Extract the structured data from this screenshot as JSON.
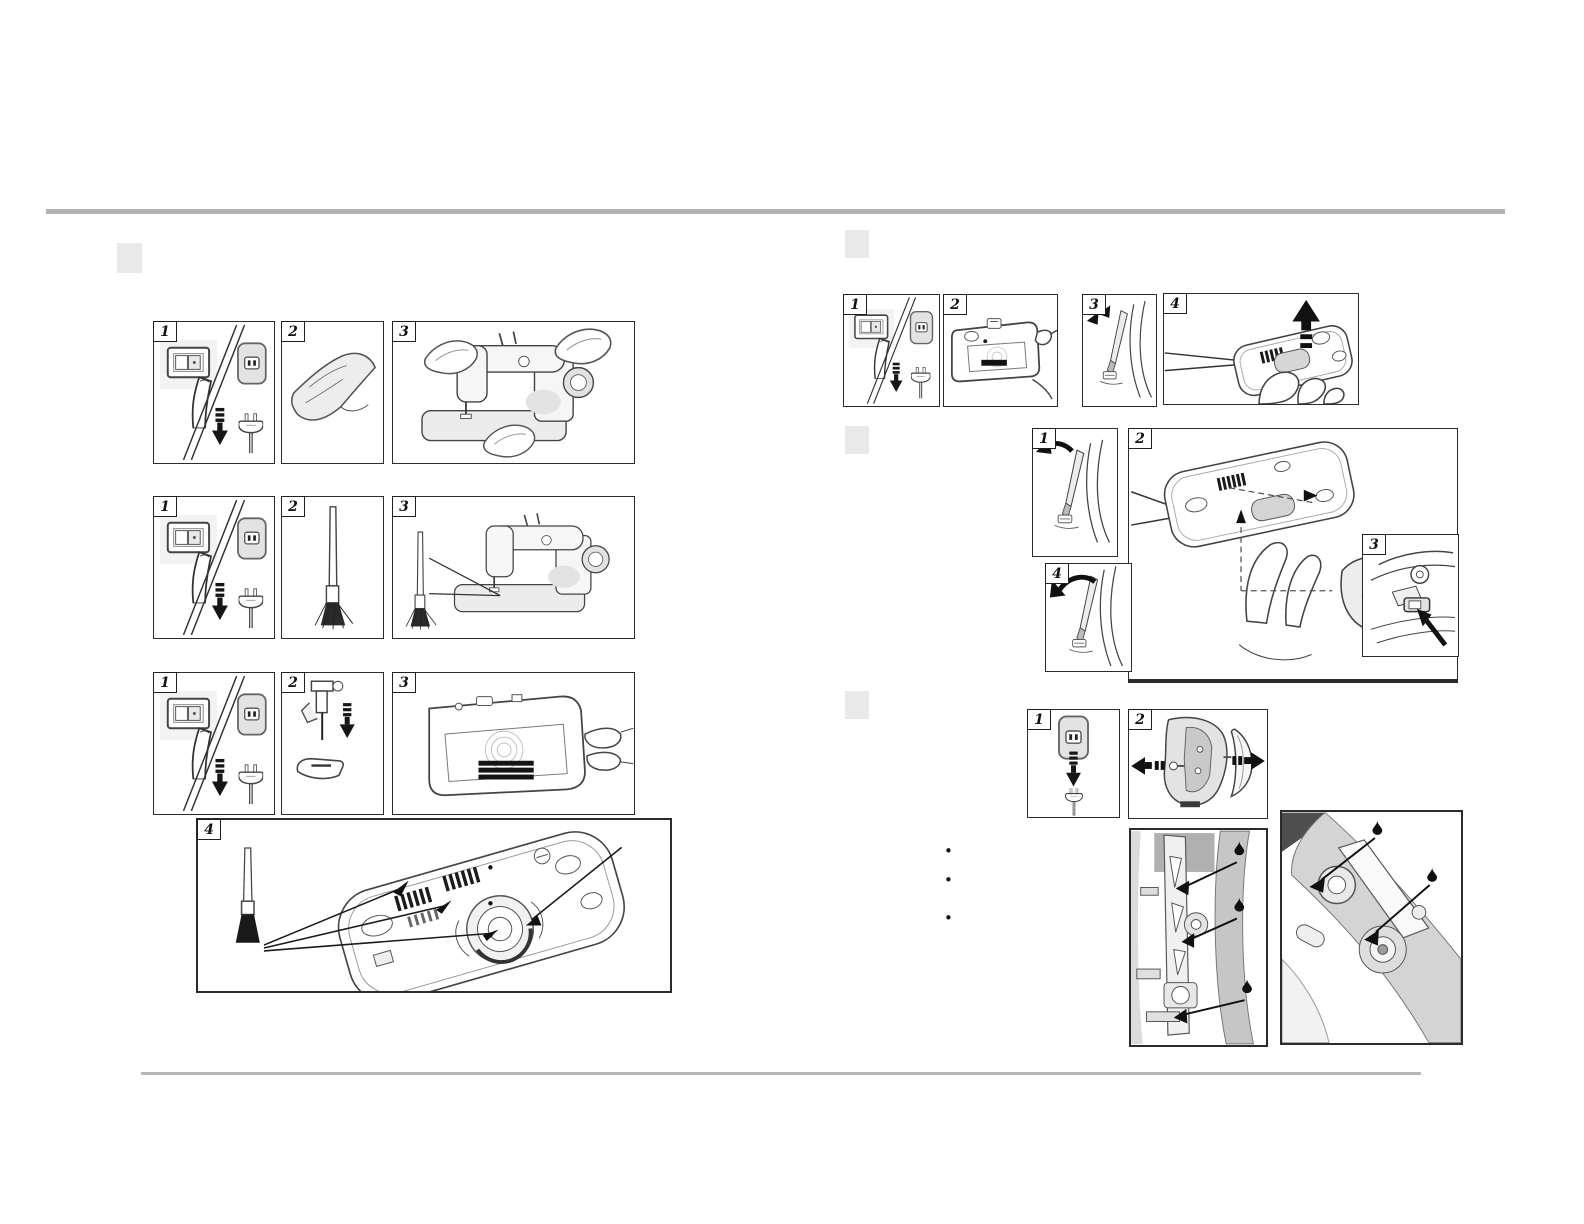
{
  "page": {
    "kind": "sewing-machine manual page – cleaning and oiling instructions",
    "top_rule_color": "#b1b3b5",
    "bottom_rule_color": "#b6b6b6",
    "section_marker_color": "#e9e9ea"
  },
  "glyphs": {
    "bullet": "•"
  },
  "left": {
    "rows": [
      {
        "steps": [
          {
            "num": "1",
            "icon": "power-off-and-unplug"
          },
          {
            "num": "2",
            "icon": "soft-cloth"
          },
          {
            "num": "3",
            "icon": "wipe-machine-with-cloth-pads"
          }
        ]
      },
      {
        "steps": [
          {
            "num": "1",
            "icon": "power-off-and-unplug"
          },
          {
            "num": "2",
            "icon": "lint-brush"
          },
          {
            "num": "3",
            "icon": "brush-machine-exterior"
          }
        ]
      },
      {
        "steps": [
          {
            "num": "1",
            "icon": "power-off-and-unplug"
          },
          {
            "num": "2",
            "icon": "remove-presser-foot-and-needle"
          },
          {
            "num": "3",
            "icon": "remove-needle-plate-by-hand"
          }
        ]
      }
    ],
    "detail": {
      "num": "4",
      "icon": "brush-feed-dogs-and-hook-race",
      "bullets": [
        "•",
        "•",
        "•"
      ]
    }
  },
  "right": {
    "top": {
      "steps": [
        {
          "num": "1",
          "icon": "power-off-and-unplug"
        },
        {
          "num": "2",
          "icon": "remove-bobbin-cover-plate"
        },
        {
          "num": "3",
          "icon": "loosen-needle-plate-screws"
        },
        {
          "num": "4",
          "icon": "lift-needle-plate-up"
        }
      ]
    },
    "middle": {
      "steps": [
        {
          "num": "1",
          "icon": "loosen-screw-with-screwdriver"
        },
        {
          "num": "2",
          "icon": "remove-and-insert-bobbin-case"
        },
        {
          "num": "3",
          "icon": "bobbin-case-latch-detail"
        },
        {
          "num": "4",
          "icon": "tighten-screw-with-screwdriver"
        }
      ]
    },
    "bottom": {
      "steps": [
        {
          "num": "1",
          "icon": "unplug-power-cord"
        },
        {
          "num": "2",
          "icon": "remove-face-plate-and-screw"
        }
      ],
      "bullets": [
        "•",
        "•",
        "•"
      ],
      "oil_drops": {
        "left_panel": 3,
        "right_panel": 2
      }
    }
  }
}
